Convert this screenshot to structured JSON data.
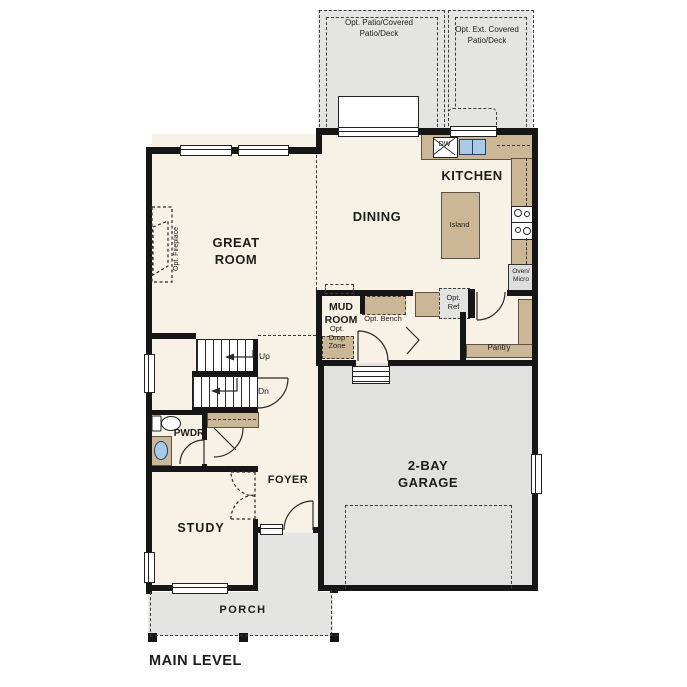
{
  "plan": {
    "title": "MAIN LEVEL",
    "rooms": {
      "great_room": "GREAT ROOM",
      "dining": "DINING",
      "kitchen": "KITCHEN",
      "mud_room": "MUD ROOM",
      "pantry": "Pantry",
      "pwdr": "PWDR",
      "foyer": "FOYER",
      "study": "STUDY",
      "garage": "2-BAY GARAGE",
      "porch": "PORCH"
    },
    "fixtures": {
      "island": "Island",
      "dishwasher": "DW",
      "oven_micro": "Oven/ Micro",
      "opt_ref": "Opt. Ref",
      "opt_bench": "Opt. Bench",
      "opt_drop_zone": "Opt. Drop Zone",
      "opt_fireplace": "Opt. Fireplace"
    },
    "outdoor": {
      "patio_left": "Opt. Patio/Covered Patio/Deck",
      "patio_right": "Opt. Ext. Covered Patio/Deck"
    },
    "stairs": {
      "up": "Up",
      "down": "Dn"
    },
    "colors": {
      "floor": "#f8f1e5",
      "cabinet_tan": "#cbb795",
      "exterior_gray": "#e4e4e2",
      "wall": "#161616",
      "sink_blue": "#a9cbe8"
    }
  }
}
